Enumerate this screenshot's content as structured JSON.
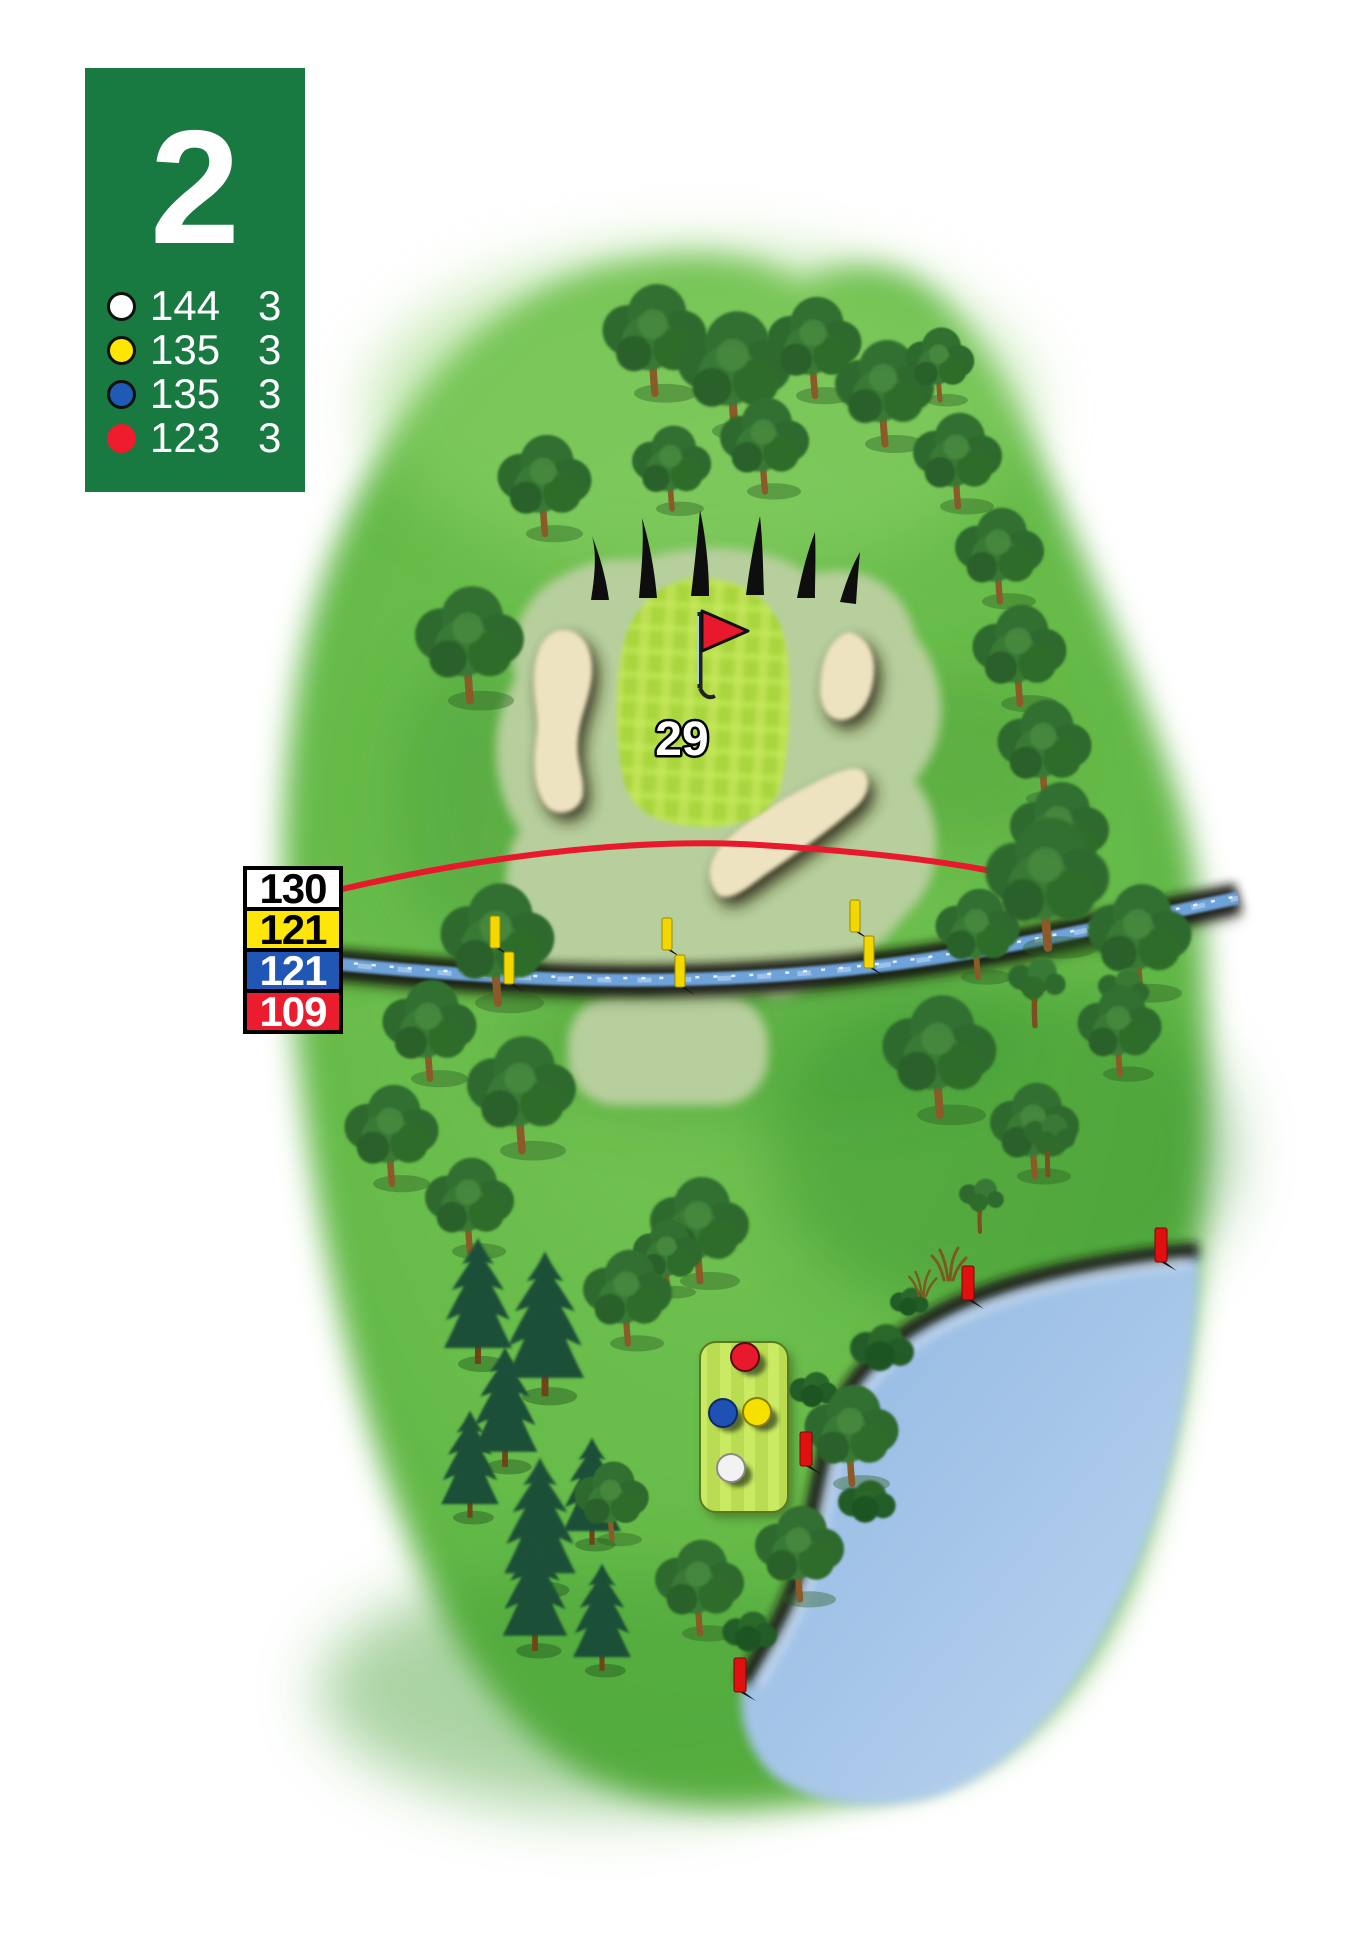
{
  "hole_card": {
    "hole_number": "2",
    "background_color": "#187a41",
    "tees": [
      {
        "name": "white",
        "color": "#ffffff",
        "distance": "144",
        "par": "3"
      },
      {
        "name": "yellow",
        "color": "#ffe600",
        "distance": "135",
        "par": "3"
      },
      {
        "name": "blue",
        "color": "#1f5ab4",
        "distance": "135",
        "par": "3"
      },
      {
        "name": "red",
        "color": "#ee1c2d",
        "distance": "123",
        "par": "3"
      }
    ]
  },
  "distance_markers": [
    {
      "tee": "white",
      "label": "130",
      "background": "#ffffff",
      "text_color": "#000000"
    },
    {
      "tee": "yellow",
      "label": "121",
      "background": "#ffe60a",
      "text_color": "#000000"
    },
    {
      "tee": "blue",
      "label": "121",
      "background": "#2056b4",
      "text_color": "#ffffff"
    },
    {
      "tee": "red",
      "label": "109",
      "background": "#ea1c2d",
      "text_color": "#ffffff"
    }
  ],
  "green_depth_label": "29",
  "map_colors": {
    "fairway": "#63b848",
    "fringe": "#b7cf9c",
    "putting_green": "#a9d63d",
    "sand": "#eee3c0",
    "stream_water": "#6ea3da",
    "pond_water": "#9fc0e8",
    "target_line": "#e8192c",
    "flag": "#e8192c",
    "hazard_stake_yellow": "#f2d800",
    "hazard_stake_red": "#e01010"
  }
}
